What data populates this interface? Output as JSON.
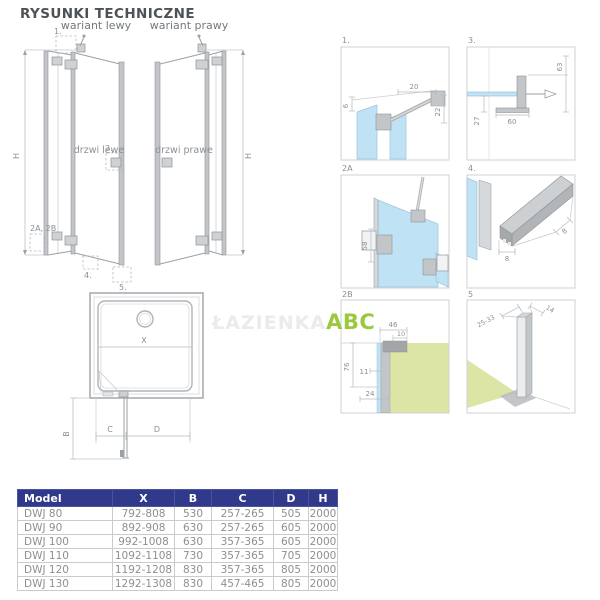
{
  "page": {
    "title": "RYSUNKI TECHNICZNE"
  },
  "watermark": {
    "faint": "ŁAZIENKA",
    "brand": "ABC"
  },
  "variants": {
    "left": {
      "label": "wariant lewy",
      "door": "drzwi lewe",
      "height": "H",
      "callout_1": "1.",
      "callout_3": "3.",
      "callout_2": "2A, 2B",
      "callout_4": "4.",
      "callout_5": "5."
    },
    "right": {
      "label": "wariant prawy",
      "door": "drzwi prawe",
      "height": "H"
    }
  },
  "tray": {
    "x": "X",
    "b": "B",
    "c": "C",
    "d": "D"
  },
  "details": {
    "d1": {
      "label": "1.",
      "dim_top": "20",
      "dim_left": "6",
      "dim_right": "22"
    },
    "d3": {
      "label": "3.",
      "dim_right": "63",
      "dim_left": "27",
      "dim_bottom": "60"
    },
    "d2a": {
      "label": "2A",
      "dim_left": "58"
    },
    "d4": {
      "label": "4.",
      "dim_bottom": "8",
      "dim_side": "8"
    },
    "d2b": {
      "label": "2B",
      "dim_top": "46",
      "dim_top_inner": "10",
      "dim_left": "76",
      "dim_mid": "11",
      "dim_bottom": "24"
    },
    "d5": {
      "label": "5",
      "dim_left": "25-33",
      "dim_right": "14"
    }
  },
  "table": {
    "headers": [
      "Model",
      "X",
      "B",
      "C",
      "D",
      "H"
    ],
    "rows": [
      [
        "DWJ 80",
        "792-808",
        "530",
        "257-265",
        "505",
        "2000"
      ],
      [
        "DWJ 90",
        "892-908",
        "630",
        "257-265",
        "605",
        "2000"
      ],
      [
        "DWJ 100",
        "992-1008",
        "630",
        "357-365",
        "605",
        "2000"
      ],
      [
        "DWJ 110",
        "1092-1108",
        "730",
        "357-365",
        "705",
        "2000"
      ],
      [
        "DWJ 120",
        "1192-1208",
        "830",
        "357-365",
        "805",
        "2000"
      ],
      [
        "DWJ 130",
        "1292-1308",
        "830",
        "457-465",
        "805",
        "2000"
      ]
    ]
  },
  "colors": {
    "glass": "#bfe2f4",
    "wall": "#dde5a6",
    "profile": "#c3c6c9",
    "line": "#9aa0a4",
    "table_header": "#31398b",
    "brand_green": "#9bc93e"
  }
}
